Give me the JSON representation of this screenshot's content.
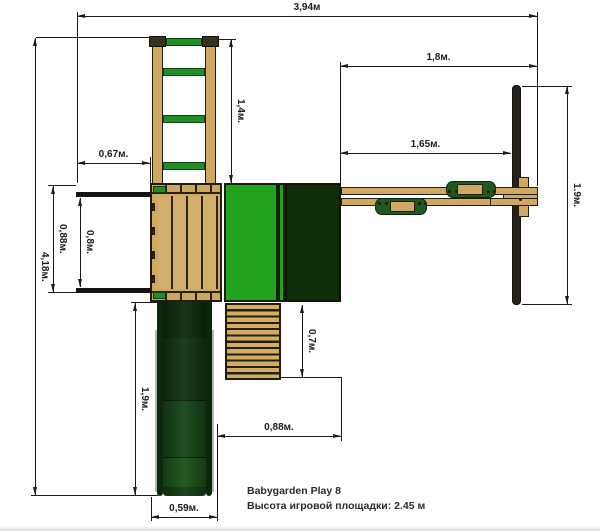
{
  "caption": {
    "line1": "Babygarden Play 8",
    "line2": "Высота игровой площадки: 2.45 м"
  },
  "dimensions": {
    "total_width": "3,94м",
    "swing_section": "1,8м.",
    "beam_to_post": "1,65м.",
    "ladder": "1,4м.",
    "balcony_width": "0,67м.",
    "total_depth": "4,18м.",
    "platform_depth": "0,88м.",
    "balcony_opening": "0,8м.",
    "slide_length": "1,9м.",
    "steps_length": "0,7м.",
    "steps_to_tower": "0,88м.",
    "slide_width": "0,59м.",
    "aframe_footprint": "1.9м."
  },
  "colors": {
    "line": "#1b1b1b",
    "wood": "#cfa961",
    "wood_light": "#d2af68",
    "bright_green": "#22a31e",
    "dark_green": "#0e2d0a",
    "accent_green": "#1e9122",
    "seat_green": "#1d5a1d",
    "slide_green": "#174517"
  }
}
